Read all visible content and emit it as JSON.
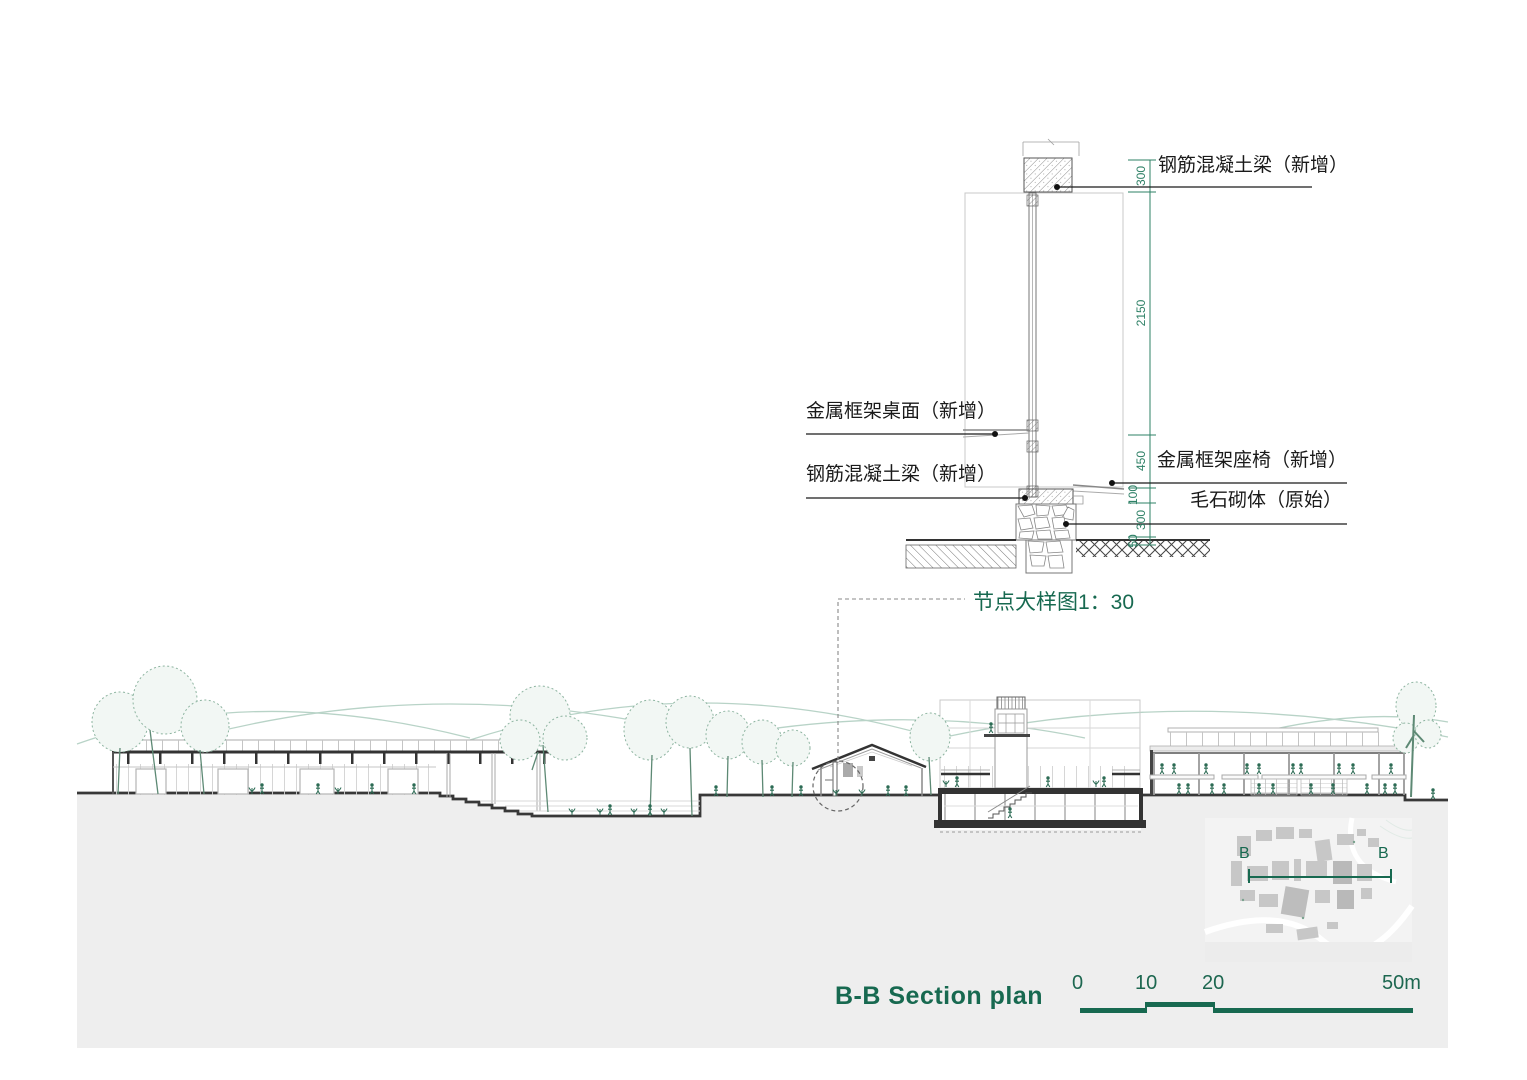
{
  "detail": {
    "note": "节点大样图1：30",
    "labels": {
      "beam_top": "钢筋混凝土梁（新增）",
      "desk": "金属框架桌面（新增）",
      "beam_left": "钢筋混凝土梁（新增）",
      "seat": "金属框架座椅（新增）",
      "masonry": "毛石砌体（原始）"
    },
    "dims": [
      "300",
      "2150",
      "450",
      "100",
      "300",
      "50"
    ]
  },
  "section": {
    "title": "B-B Section plan",
    "marker": "B"
  },
  "scale_bar": {
    "ticks": [
      "0",
      "10",
      "20",
      "50m"
    ]
  },
  "colors": {
    "accent_green": "#176950",
    "dim_green": "#2e8066",
    "hill_green": "#b8d3c7",
    "people_green": "#2c6b54",
    "ground_gray": "#eeeeee",
    "line_dark": "#333333"
  }
}
